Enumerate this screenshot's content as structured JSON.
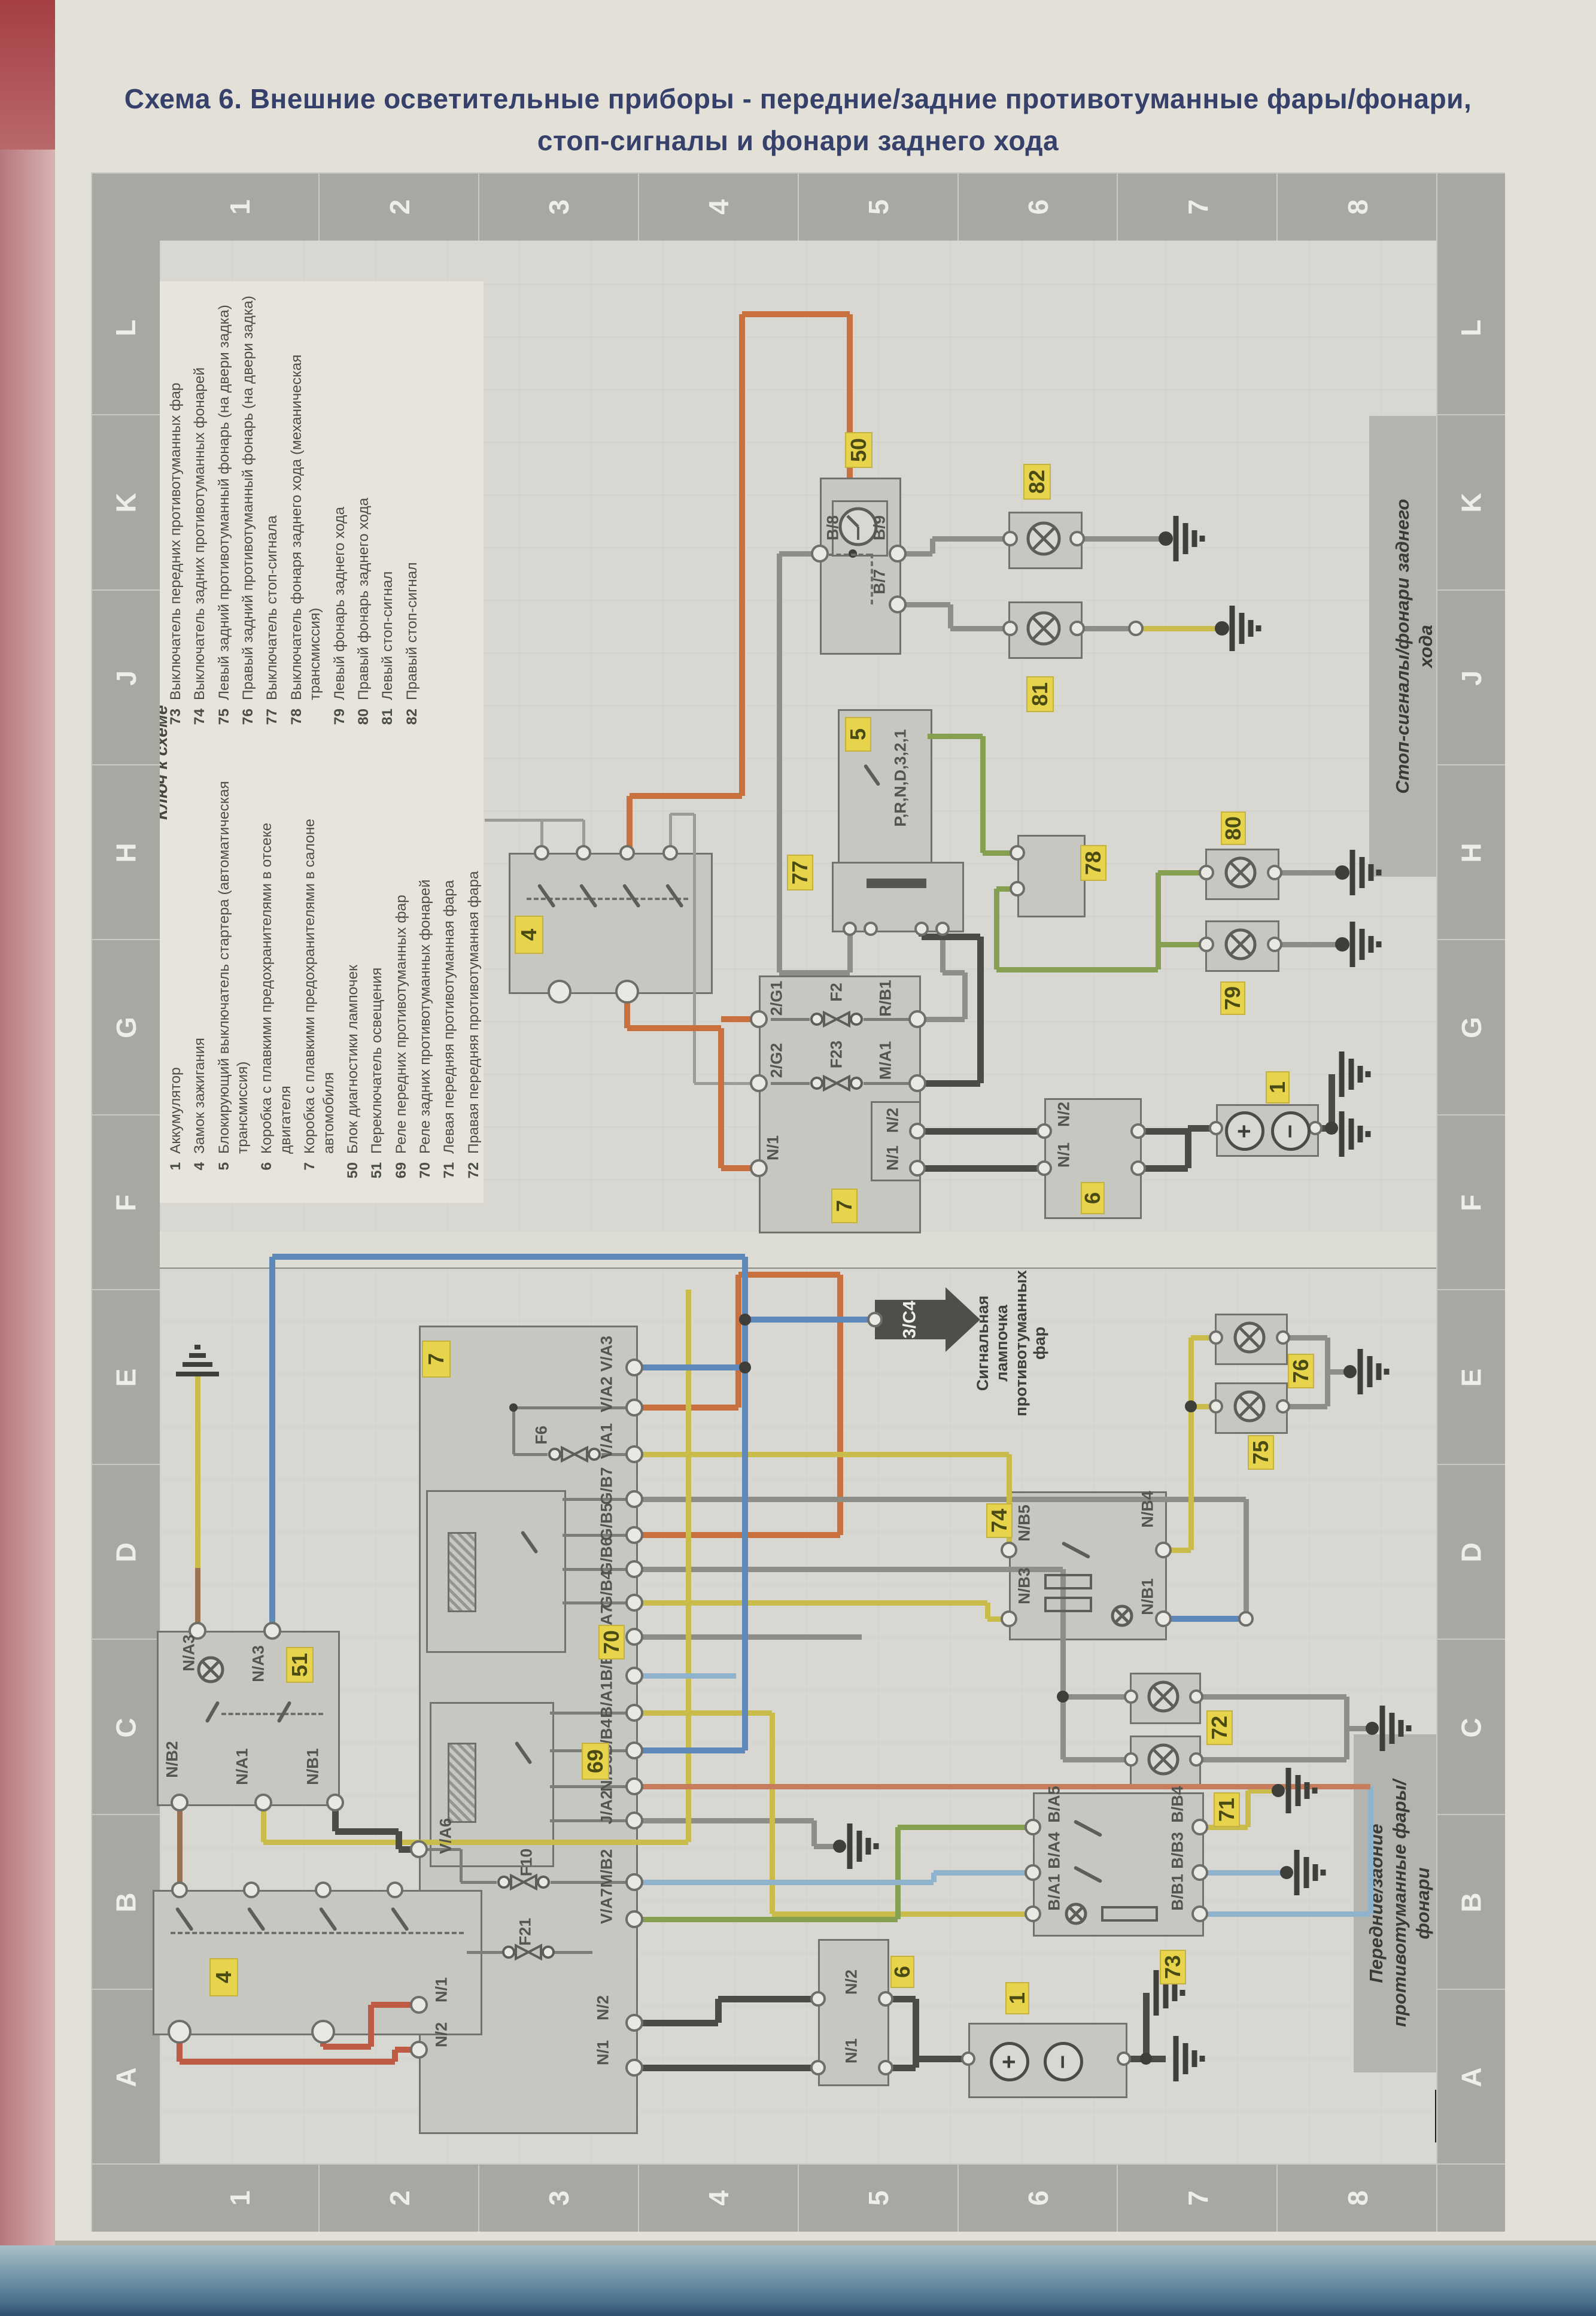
{
  "title": {
    "line1": "Схема 6. Внешние осветительные приборы - передние/задние противотуманные фары/фонари,",
    "line2": "стоп-сигналы и фонари заднего хода"
  },
  "page_marker": "C",
  "border": {
    "numbers": [
      "1",
      "2",
      "3",
      "4",
      "5",
      "6",
      "7",
      "8"
    ],
    "letters": [
      "L",
      "K",
      "J",
      "H",
      "G",
      "F",
      "E",
      "D",
      "C",
      "B",
      "A"
    ]
  },
  "legend": {
    "header": "Ключ к схеме",
    "items": [
      {
        "num": "1",
        "label": "Аккумулятор"
      },
      {
        "num": "4",
        "label": "Замок зажигания"
      },
      {
        "num": "5",
        "label": "Блокирующий выключатель стартера (автоматическая трансмиссия)"
      },
      {
        "num": "6",
        "label": "Коробка с плавкими предохранителями в отсеке двигателя"
      },
      {
        "num": "7",
        "label": "Коробка с плавкими предохранителями в салоне автомобиля"
      },
      {
        "num": "50",
        "label": "Блок диагностики лампочек"
      },
      {
        "num": "51",
        "label": "Переключатель освещения"
      },
      {
        "num": "69",
        "label": "Реле передних противотуманных фар"
      },
      {
        "num": "70",
        "label": "Реле задних противотуманных фонарей"
      },
      {
        "num": "71",
        "label": "Левая передняя противотуманная фара"
      },
      {
        "num": "72",
        "label": "Правая передняя противотуманная фара"
      },
      {
        "num": "73",
        "label": "Выключатель передних противотуманных фар"
      },
      {
        "num": "74",
        "label": "Выключатель задних противотуманных фонарей"
      },
      {
        "num": "75",
        "label": "Левый задний противотуманный фонарь (на двери задка)"
      },
      {
        "num": "76",
        "label": "Правый задний противотуманный фонарь (на двери задка)"
      },
      {
        "num": "77",
        "label": "Выключатель стоп-сигнала"
      },
      {
        "num": "78",
        "label": "Выключатель фонаря заднего хода (механическая трансмиссия)"
      },
      {
        "num": "79",
        "label": "Левый фонарь заднего хода"
      },
      {
        "num": "80",
        "label": "Правый фонарь заднего хода"
      },
      {
        "num": "81",
        "label": "Левый стоп-сигнал"
      },
      {
        "num": "82",
        "label": "Правый стоп-сигнал"
      }
    ]
  },
  "labels": {
    "stop_side": "Стоп-сигналы/фонари заднего хода",
    "fog_side": "Передние/задние противотуманные фары/фонари",
    "signal_note": "Сигнальная лампочка противотуманных фар",
    "arrow": "3/C4"
  },
  "upper": {
    "b4": {
      "tag": "4"
    },
    "b50": {
      "tag": "50",
      "b8": "B/8",
      "b9": "B/9",
      "b7": "B/7"
    },
    "l82": {
      "tag": "82"
    },
    "l81": {
      "tag": "81"
    },
    "b5": {
      "tag": "5",
      "gears": "P,R,N,D,3,2,1"
    },
    "sw77": {
      "tag": "77"
    },
    "sw78": {
      "tag": "78"
    },
    "box7": {
      "tag": "7",
      "g1": "2/G1",
      "f2": "F2",
      "rb1": "R/B1",
      "g2": "2/G2",
      "f23": "F23",
      "ma1": "M/A1",
      "n2": "N/2",
      "n1": "N/1",
      "n1l": "N/1"
    },
    "box6": {
      "tag": "6",
      "n2": "N/2",
      "n1": "N/1"
    },
    "bat": {
      "tag": "1",
      "plus": "+",
      "minus": "−"
    },
    "l80": {
      "tag": "80"
    },
    "l79": {
      "tag": "79"
    }
  },
  "lower": {
    "box7": {
      "tag": "7",
      "va3": "V/A3",
      "va2": "V/A2",
      "va1": "V/A1",
      "f6": "F6",
      "gb7": "G/B7",
      "gb5": "G/B5",
      "gb6": "G/B6",
      "gb4": "G/B4",
      "ga7": "G/A7",
      "bb3": "B/B3",
      "ba1": "B/A1",
      "bb4": "B/B4",
      "nb3": "N/B3",
      "ja2": "J/A2",
      "mb2": "M/B2",
      "f10": "F10",
      "va7": "V/A7",
      "va6": "V/A6",
      "f21": "F21",
      "n1l": "N/1",
      "n2l": "N/2",
      "n2r": "N/2",
      "n1r": "N/1"
    },
    "r70": {
      "tag": "70"
    },
    "r69": {
      "tag": "69"
    },
    "sw51": {
      "tag": "51",
      "na3a": "N/A3",
      "na3b": "N/A3",
      "nb2": "N/B2",
      "na1": "N/A1",
      "nb1": "N/B1"
    },
    "sw4": {
      "tag": "4"
    },
    "sw74": {
      "tag": "74",
      "nb5": "N/B5",
      "nb4": "N/B4",
      "nb3": "N/B3",
      "nb1": "N/B1"
    },
    "sw73": {
      "tag": "73",
      "ba5": "B/A5",
      "bb4": "B/B4",
      "ba4": "B/A4",
      "bb3": "B/B3",
      "ba1": "B/A1",
      "bb1": "B/B1"
    },
    "l76": {
      "tag": "76"
    },
    "l75": {
      "tag": "75"
    },
    "l72": {
      "tag": "72"
    },
    "l71": {
      "tag": "71"
    },
    "box6": {
      "tag": "6",
      "n2": "N/2",
      "n1": "N/1"
    },
    "bat": {
      "tag": "1",
      "plus": "+",
      "minus": "−"
    },
    "arrow": {
      "label": "3/C4"
    }
  }
}
